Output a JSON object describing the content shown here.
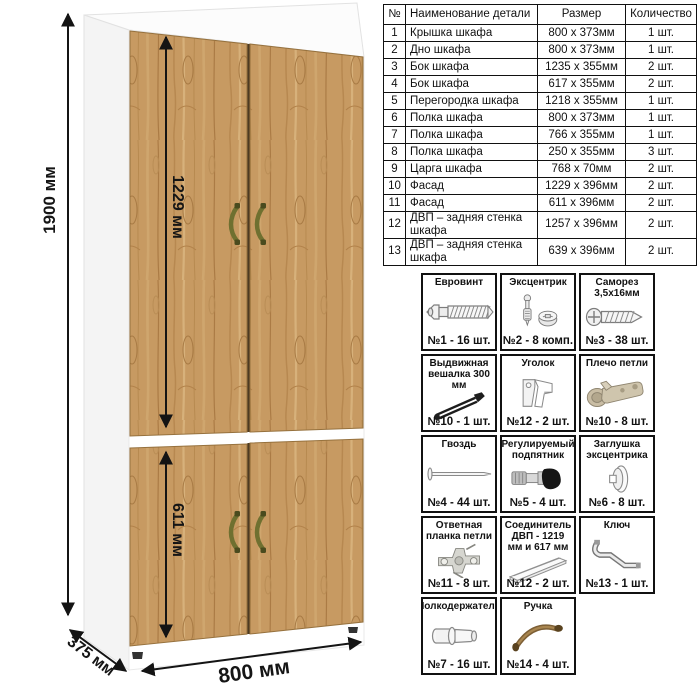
{
  "dimensions": {
    "height_label": "1900 мм",
    "upper_door_label": "1229 мм",
    "lower_door_label": "611 мм",
    "width_label": "800 мм",
    "depth_label": "375 мм"
  },
  "parts_table": {
    "headers": [
      "№",
      "Наименование детали",
      "Размер",
      "Количество"
    ],
    "rows": [
      [
        "1",
        "Крышка шкафа",
        "800 x 373мм",
        "1 шт."
      ],
      [
        "2",
        "Дно шкафа",
        "800 x 373мм",
        "1 шт."
      ],
      [
        "3",
        "Бок шкафа",
        "1235 x 355мм",
        "2 шт."
      ],
      [
        "4",
        "Бок шкафа",
        "617 x 355мм",
        "2 шт."
      ],
      [
        "5",
        "Перегородка шкафа",
        "1218 x 355мм",
        "1 шт."
      ],
      [
        "6",
        "Полка шкафа",
        "800 x 373мм",
        "1 шт."
      ],
      [
        "7",
        "Полка шкафа",
        "766 x 355мм",
        "1 шт."
      ],
      [
        "8",
        "Полка шкафа",
        "250 x 355мм",
        "3 шт."
      ],
      [
        "9",
        "Царга шкафа",
        "768 x 70мм",
        "2 шт."
      ],
      [
        "10",
        "Фасад",
        "1229 x 396мм",
        "2 шт."
      ],
      [
        "11",
        "Фасад",
        "611 x 396мм",
        "2 шт."
      ],
      [
        "12",
        "ДВП – задняя стенка шкафа",
        "1257 x 396мм",
        "2 шт."
      ],
      [
        "13",
        "ДВП – задняя стенка шкафа",
        "639 x 396мм",
        "2 шт."
      ]
    ]
  },
  "hardware": {
    "items": [
      {
        "title": "Евровинт",
        "icon": "euro-screw-icon",
        "qty": "№1 - 16 шт."
      },
      {
        "title": "Эксцентрик",
        "icon": "cam-bolt-icon",
        "qty": "№2 - 8 комп."
      },
      {
        "title": "Саморез 3,5х16мм",
        "icon": "self-tapping-screw-icon",
        "qty": "№3 - 38 шт."
      },
      {
        "title": "Выдвижная вешалка 300 мм",
        "icon": "pullout-hanger-icon",
        "qty": "№10 - 1 шт."
      },
      {
        "title": "Уголок",
        "icon": "corner-bracket-icon",
        "qty": "№12 - 2 шт."
      },
      {
        "title": "Плечо петли",
        "icon": "hinge-arm-icon",
        "qty": "№10 - 8 шт."
      },
      {
        "title": "Гвоздь",
        "icon": "nail-icon",
        "qty": "№4 - 44 шт."
      },
      {
        "title": "Регулируемый подпятник",
        "icon": "adjustable-foot-icon",
        "qty": "№5 - 4 шт."
      },
      {
        "title": "Заглушка эксцентрика",
        "icon": "cam-cover-icon",
        "qty": "№6 - 8 шт."
      },
      {
        "title": "Ответная планка петли",
        "icon": "hinge-plate-icon",
        "qty": "№11 - 8 шт."
      },
      {
        "title": "Соединитель ДВП - 1219 мм и 617 мм",
        "icon": "hdf-connector-icon",
        "qty": "№12 - 2 шт."
      },
      {
        "title": "Ключ",
        "icon": "key-icon",
        "qty": "№13 - 1 шт."
      },
      {
        "title": "Полкодержатель",
        "icon": "shelf-pin-icon",
        "qty": "№7 - 16 шт."
      },
      {
        "title": "Ручка",
        "icon": "handle-icon",
        "qty": "№14 - 4 шт."
      }
    ]
  },
  "colors": {
    "wood": "#c79a62",
    "wood_dark": "#a87a44",
    "carcass": "#ffffff",
    "dimension_line": "#141414",
    "door_handle_olive": "#6f7030",
    "pull_handle_bronze": "#7d5f35"
  }
}
